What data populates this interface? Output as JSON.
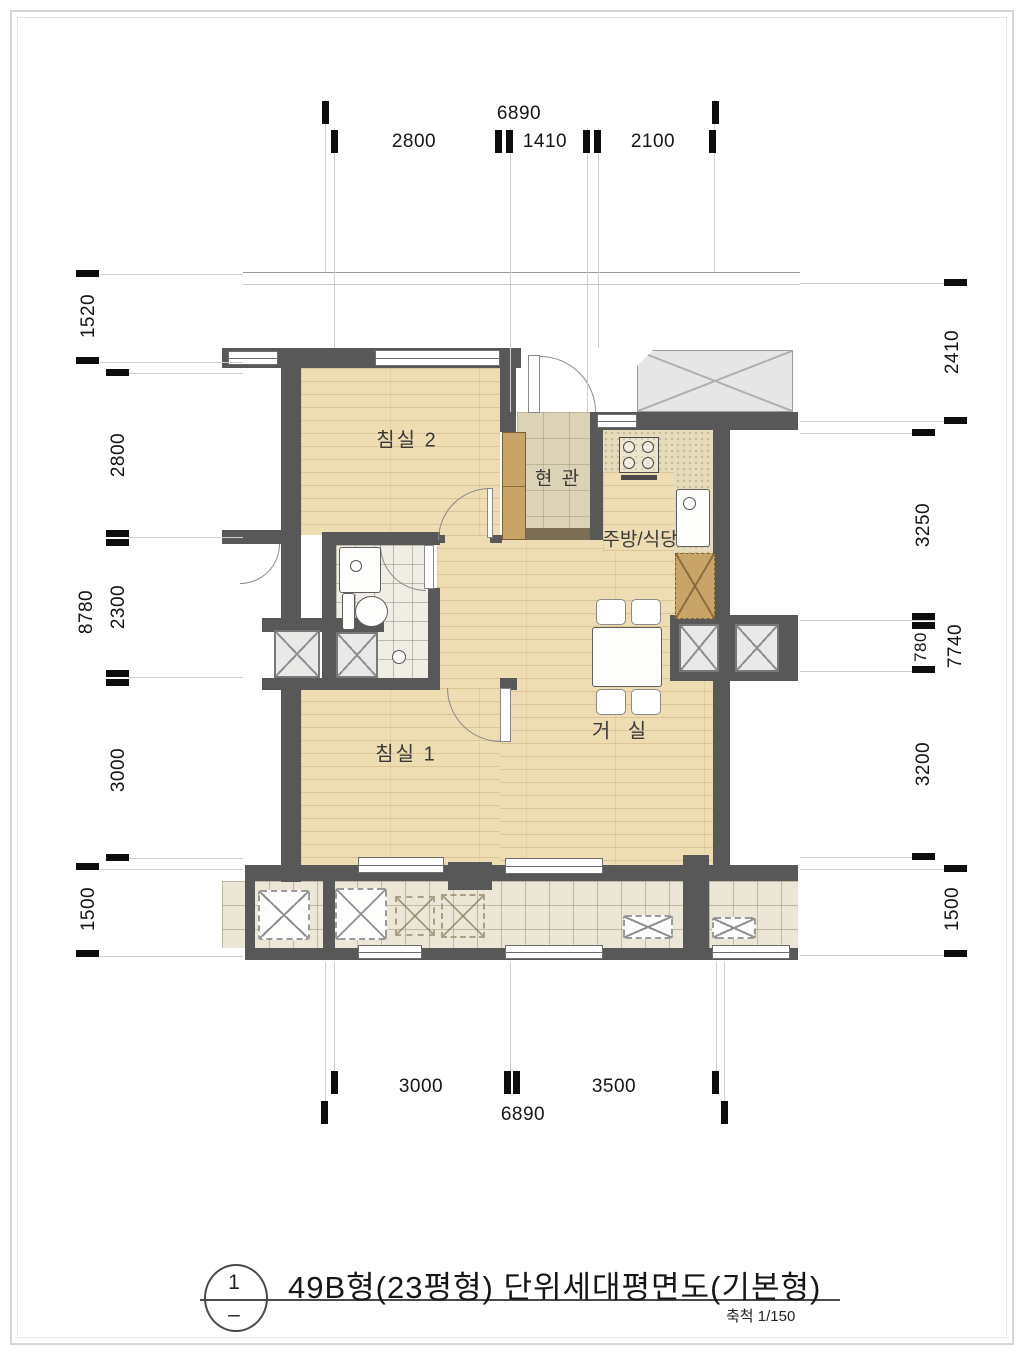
{
  "rooms": {
    "bedroom2": "침실 2",
    "entrance": "현 관",
    "kitchen": "주방/식당",
    "bedroom1": "침실 1",
    "living": "거 실"
  },
  "dimensions": {
    "top": {
      "total": "6890",
      "seg1": "2800",
      "seg2": "1410",
      "seg3": "2100"
    },
    "bottom": {
      "total": "6890",
      "seg1": "3000",
      "seg2": "3500"
    },
    "left": {
      "outer1": "1520",
      "outer2": "8780",
      "outer3": "1500",
      "inner1": "2800",
      "inner2": "2300",
      "inner3": "3000"
    },
    "right": {
      "outer1": "2410",
      "outer2": "7740",
      "outer3": "1500",
      "inner1": "3250",
      "inner2": "780",
      "inner3": "3200"
    }
  },
  "title_block": {
    "number": "1",
    "sub_mark": "–",
    "title": "49B형(23평형) 단위세대평면도(기본형)",
    "scale": "축척 1/150"
  },
  "colors": {
    "wall": "#585858",
    "wood_floor": "#eedcb3",
    "entrance_tile": "#dcd2b6",
    "bathroom_tile": "#efede4",
    "balcony_tile": "#ebe6d6",
    "cabinet": "#c9a469",
    "duct_fill": "#e9e9e7"
  }
}
